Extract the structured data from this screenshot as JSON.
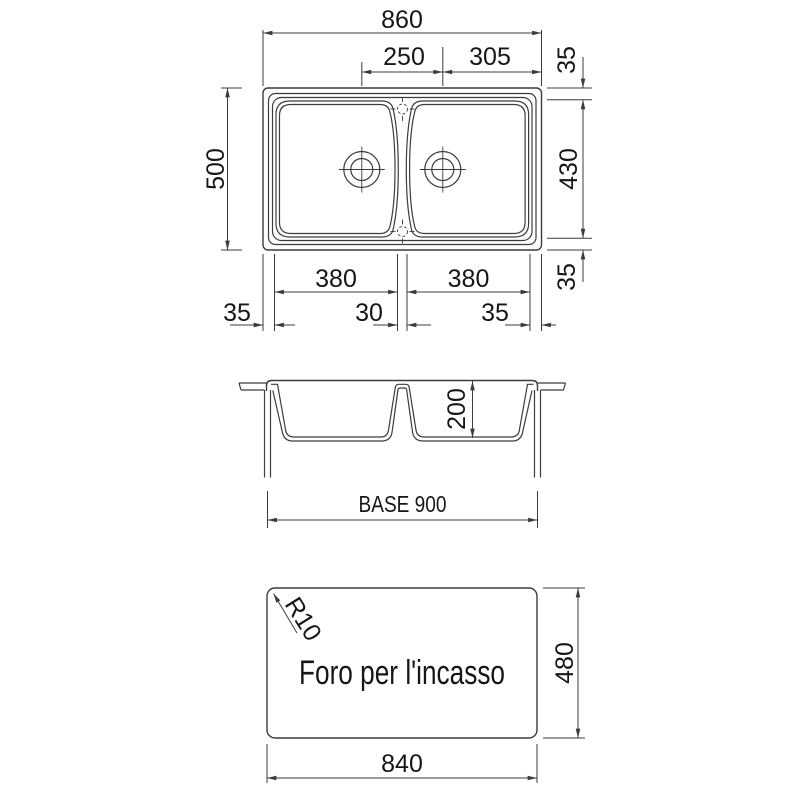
{
  "colors": {
    "line": "#3c3c3c",
    "text": "#161616",
    "background": "#ffffff"
  },
  "views": {
    "top": {
      "dims": {
        "overall_width": "860",
        "drain_spacing": "250",
        "drain_to_right": "305",
        "margin_back": "35",
        "overall_depth": "500",
        "bowl_depth": "430",
        "margin_front": "35",
        "bowl_left_width": "380",
        "bowl_right_width": "380",
        "margin_left": "35",
        "divider_width": "30",
        "margin_right": "35"
      }
    },
    "section": {
      "dims": {
        "bowl_height": "200",
        "base_width": "BASE 900"
      }
    },
    "cutout": {
      "label": "Foro per l'incasso",
      "dims": {
        "corner_radius": "R10",
        "height": "480",
        "width": "840"
      }
    }
  }
}
